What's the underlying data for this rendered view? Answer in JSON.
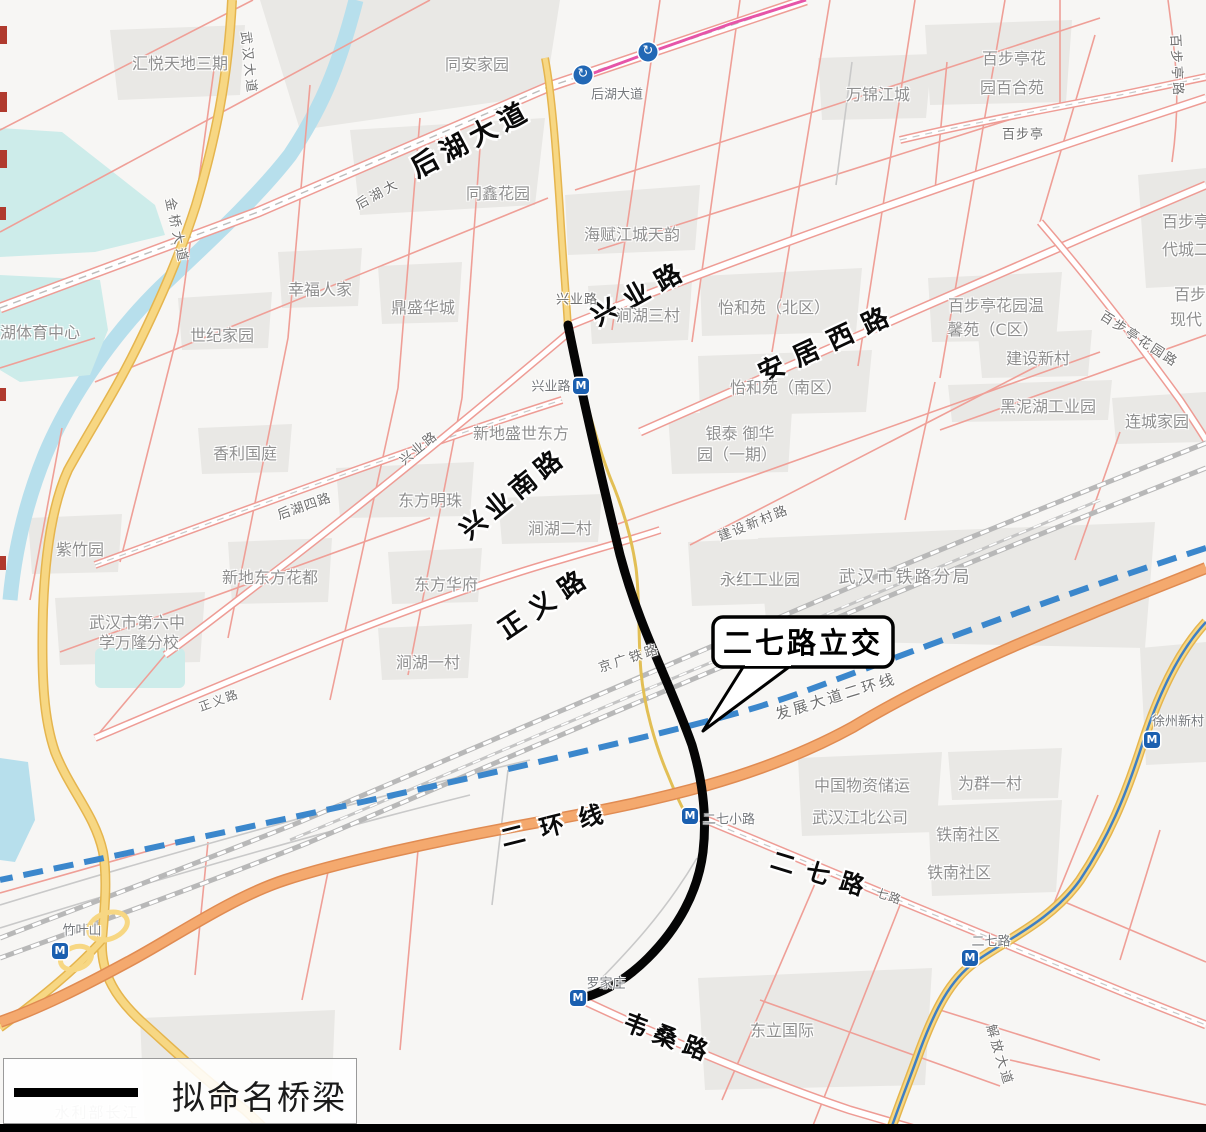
{
  "legend": {
    "label": "拟命名桥梁"
  },
  "callout": {
    "label": "二七路立交"
  },
  "colors": {
    "water": "#b7dfec",
    "lake": "#cdecea",
    "pink_road": "#ef9f97",
    "yellow_road": "#f7d783",
    "orange_road": "#f4a96e",
    "rail": "#b8b8b8",
    "metro_construction_blue": "#3b87cc",
    "metro_magenta": "#e655a8",
    "metro_icon_blue": "#1a5fb0",
    "bridge_black": "#050505"
  },
  "icons": {
    "station": {
      "name": "metro-station-icon",
      "glyph": "M"
    },
    "interchange": {
      "name": "road-interchange-icon",
      "glyph": "↻"
    }
  },
  "metro_icons": [
    {
      "kind": "interchange",
      "x": 583,
      "y": 75
    },
    {
      "kind": "interchange",
      "x": 648,
      "y": 52
    },
    {
      "kind": "station",
      "x": 581,
      "y": 386
    },
    {
      "kind": "station",
      "x": 690,
      "y": 816
    },
    {
      "kind": "station",
      "x": 578,
      "y": 998
    },
    {
      "kind": "station",
      "x": 60,
      "y": 951
    },
    {
      "kind": "station",
      "x": 970,
      "y": 958
    },
    {
      "kind": "station",
      "x": 1152,
      "y": 740
    }
  ],
  "labels": [
    {
      "text": "后湖大道",
      "x": 470,
      "y": 137,
      "cls": "rb",
      "rot": -28,
      "size": 27,
      "ls": 6
    },
    {
      "text": "兴业路",
      "x": 640,
      "y": 291,
      "cls": "rb",
      "rot": -29,
      "size": 26,
      "ls": 10
    },
    {
      "text": "安居西路",
      "x": 828,
      "y": 341,
      "cls": "rb",
      "rot": -25,
      "size": 26,
      "ls": 12
    },
    {
      "text": "兴业南路",
      "x": 512,
      "y": 492,
      "cls": "rb",
      "rot": -39,
      "size": 26,
      "ls": 6
    },
    {
      "text": "正义路",
      "x": 545,
      "y": 601,
      "cls": "rb",
      "rot": -34,
      "size": 26,
      "ls": 10
    },
    {
      "text": "二环线",
      "x": 559,
      "y": 822,
      "cls": "rb",
      "rot": -14,
      "size": 24,
      "ls": 16
    },
    {
      "text": "二七路",
      "x": 824,
      "y": 873,
      "cls": "rb",
      "rot": 17,
      "size": 24,
      "ls": 12
    },
    {
      "text": "韦桑路",
      "x": 670,
      "y": 1036,
      "cls": "rb",
      "rot": 21,
      "size": 24,
      "ls": 8
    },
    {
      "text": "后湖大",
      "x": 377,
      "y": 193,
      "cls": "rs",
      "rot": -29,
      "size": 13,
      "ls": 3
    },
    {
      "text": "兴业路",
      "x": 577,
      "y": 298,
      "cls": "rs",
      "rot": 0,
      "size": 13,
      "ls": 1
    },
    {
      "text": "兴业路",
      "x": 418,
      "y": 447,
      "cls": "rs",
      "rot": -39,
      "size": 13,
      "ls": 2
    },
    {
      "text": "后湖四路",
      "x": 304,
      "y": 505,
      "cls": "rs",
      "rot": -19,
      "size": 13,
      "ls": 1
    },
    {
      "text": "金桥大道",
      "x": 178,
      "y": 231,
      "cls": "rs",
      "rot": 78,
      "size": 13,
      "ls": 4
    },
    {
      "text": "武汉大道",
      "x": 250,
      "y": 63,
      "cls": "rs",
      "rot": 84,
      "size": 13,
      "ls": 3
    },
    {
      "text": "正义路",
      "x": 219,
      "y": 700,
      "cls": "rs",
      "rot": -20,
      "size": 12,
      "ls": 2
    },
    {
      "text": "京广铁路",
      "x": 629,
      "y": 657,
      "cls": "rs",
      "rot": -18,
      "size": 13,
      "ls": 3
    },
    {
      "text": "建设新村路",
      "x": 753,
      "y": 522,
      "cls": "rs",
      "rot": -22,
      "size": 13,
      "ls": 2
    },
    {
      "text": "发展大道二环线",
      "x": 836,
      "y": 696,
      "cls": "rs",
      "rot": -17,
      "size": 15,
      "ls": 3
    },
    {
      "text": "七路",
      "x": 889,
      "y": 896,
      "cls": "rs",
      "rot": 18,
      "size": 12,
      "ls": 1
    },
    {
      "text": "解放大道",
      "x": 1001,
      "y": 1055,
      "cls": "rs",
      "rot": 73,
      "size": 13,
      "ls": 3
    },
    {
      "text": "百步亭路",
      "x": 1178,
      "y": 66,
      "cls": "rs",
      "rot": 87,
      "size": 13,
      "ls": 3
    },
    {
      "text": "百步亭花园路",
      "x": 1140,
      "y": 338,
      "cls": "rs",
      "rot": 33,
      "size": 13,
      "ls": 2
    },
    {
      "text": "百步亭",
      "x": 1023,
      "y": 133,
      "cls": "rs",
      "rot": 0,
      "size": 13,
      "ls": 1
    },
    {
      "text": "后湖大道",
      "x": 617,
      "y": 93,
      "cls": "st",
      "rot": 0,
      "size": 13,
      "ls": 0
    },
    {
      "text": "兴业路",
      "x": 551,
      "y": 385,
      "cls": "st",
      "rot": 0,
      "size": 13,
      "ls": 0
    },
    {
      "text": "二七小路",
      "x": 729,
      "y": 818,
      "cls": "st",
      "rot": 0,
      "size": 13,
      "ls": 0
    },
    {
      "text": "二七路",
      "x": 991,
      "y": 940,
      "cls": "st",
      "rot": 0,
      "size": 13,
      "ls": 0
    },
    {
      "text": "竹叶山",
      "x": 82,
      "y": 929,
      "cls": "st",
      "rot": 0,
      "size": 13,
      "ls": 0
    },
    {
      "text": "罗家庄",
      "x": 606,
      "y": 982,
      "cls": "st",
      "rot": 0,
      "size": 13,
      "ls": 0
    },
    {
      "text": "徐州新村",
      "x": 1178,
      "y": 720,
      "cls": "st",
      "rot": 0,
      "size": 13,
      "ls": 0
    },
    {
      "text": "汇悦天地三期",
      "x": 180,
      "y": 62,
      "cls": "poi"
    },
    {
      "text": "同安家园",
      "x": 477,
      "y": 63,
      "cls": "poi"
    },
    {
      "text": "同鑫花园",
      "x": 498,
      "y": 192,
      "cls": "poi"
    },
    {
      "text": "海赋江城天韵",
      "x": 632,
      "y": 233,
      "cls": "poi"
    },
    {
      "text": "幸福人家",
      "x": 320,
      "y": 288,
      "cls": "poi"
    },
    {
      "text": "鼎盛华城",
      "x": 423,
      "y": 306,
      "cls": "poi"
    },
    {
      "text": "世纪家园",
      "x": 222,
      "y": 334,
      "cls": "poi"
    },
    {
      "text": "湖体育中心",
      "x": 40,
      "y": 331,
      "cls": "poi"
    },
    {
      "text": "万锦江城",
      "x": 878,
      "y": 93,
      "cls": "poi"
    },
    {
      "text": "百步亭花",
      "x": 1014,
      "y": 57,
      "cls": "poi"
    },
    {
      "text": "园百合苑",
      "x": 1012,
      "y": 86,
      "cls": "poi"
    },
    {
      "text": "涧湖三村",
      "x": 648,
      "y": 314,
      "cls": "poi"
    },
    {
      "text": "怡和苑（北区）",
      "x": 774,
      "y": 306,
      "cls": "poi"
    },
    {
      "text": "怡和苑（南区）",
      "x": 786,
      "y": 386,
      "cls": "poi"
    },
    {
      "text": "银泰 御华",
      "x": 740,
      "y": 432,
      "cls": "poi"
    },
    {
      "text": "园（一期）",
      "x": 737,
      "y": 453,
      "cls": "poi"
    },
    {
      "text": "新地盛世东方",
      "x": 521,
      "y": 432,
      "cls": "poi"
    },
    {
      "text": "东方明珠",
      "x": 430,
      "y": 499,
      "cls": "poi"
    },
    {
      "text": "涧湖二村",
      "x": 560,
      "y": 527,
      "cls": "poi"
    },
    {
      "text": "新地东方花都",
      "x": 270,
      "y": 576,
      "cls": "poi"
    },
    {
      "text": "东方华府",
      "x": 446,
      "y": 583,
      "cls": "poi"
    },
    {
      "text": "紫竹园",
      "x": 80,
      "y": 548,
      "cls": "poi"
    },
    {
      "text": "香利国庭",
      "x": 245,
      "y": 452,
      "cls": "poi"
    },
    {
      "text": "黑泥湖工业园",
      "x": 1048,
      "y": 405,
      "cls": "poi"
    },
    {
      "text": "连城家园",
      "x": 1157,
      "y": 420,
      "cls": "poi"
    },
    {
      "text": "建设新村",
      "x": 1038,
      "y": 357,
      "cls": "poi"
    },
    {
      "text": "百步亭花园温",
      "x": 996,
      "y": 304,
      "cls": "poi"
    },
    {
      "text": "馨苑（C区）",
      "x": 993,
      "y": 328,
      "cls": "poi"
    },
    {
      "text": "百步亭",
      "x": 1186,
      "y": 220,
      "cls": "poi"
    },
    {
      "text": "代城二",
      "x": 1186,
      "y": 248,
      "cls": "poi"
    },
    {
      "text": "百步",
      "x": 1190,
      "y": 293,
      "cls": "poi"
    },
    {
      "text": "现代",
      "x": 1186,
      "y": 318,
      "cls": "poi"
    },
    {
      "text": "武汉市铁路分局",
      "x": 905,
      "y": 575,
      "cls": "poi",
      "size": 17,
      "ls": 2
    },
    {
      "text": "永红工业园",
      "x": 760,
      "y": 578,
      "cls": "poi"
    },
    {
      "text": "武汉市第六中",
      "x": 137,
      "y": 621,
      "cls": "poi"
    },
    {
      "text": "学万隆分校",
      "x": 139,
      "y": 641,
      "cls": "poi"
    },
    {
      "text": "涧湖一村",
      "x": 428,
      "y": 661,
      "cls": "poi"
    },
    {
      "text": "中国物资储运",
      "x": 862,
      "y": 784,
      "cls": "poi"
    },
    {
      "text": "武汉江北公司",
      "x": 860,
      "y": 816,
      "cls": "poi"
    },
    {
      "text": "为群一村",
      "x": 990,
      "y": 782,
      "cls": "poi"
    },
    {
      "text": "铁南社区",
      "x": 968,
      "y": 833,
      "cls": "poi"
    },
    {
      "text": "铁南社区",
      "x": 959,
      "y": 871,
      "cls": "poi"
    },
    {
      "text": "东立国际",
      "x": 782,
      "y": 1029,
      "cls": "poi"
    },
    {
      "text": "水利部长江",
      "x": 97,
      "y": 1112,
      "cls": "faded",
      "size": 15,
      "ls": 2
    }
  ]
}
